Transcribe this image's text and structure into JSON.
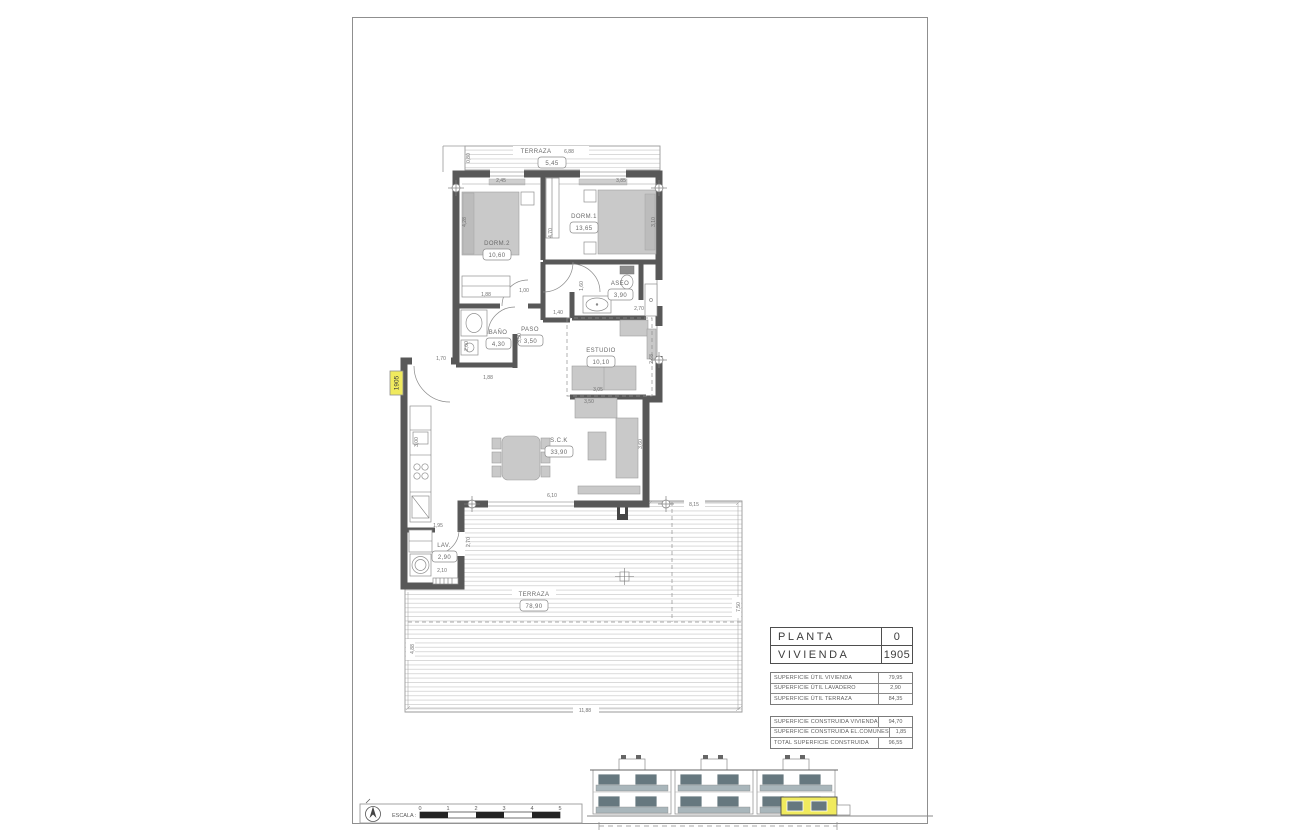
{
  "colors": {
    "wall": "#585858",
    "furniture": "#c9c9c9",
    "deck_line": "#dadada",
    "highlight_yellow": "#f0ea5e",
    "elevation_glass": "#66787f"
  },
  "plan": {
    "unit_tag": "1905",
    "rooms": [
      {
        "label": "TERRAZA",
        "area": "5,45"
      },
      {
        "label": "DORM.2",
        "area": "10,60"
      },
      {
        "label": "DORM.1",
        "area": "13,65"
      },
      {
        "label": "ASEO",
        "area": "3,90"
      },
      {
        "label": "BAÑO",
        "area": "4,30"
      },
      {
        "label": "PASO",
        "area": "3,50"
      },
      {
        "label": "ESTUDIO",
        "area": "10,10"
      },
      {
        "label": "S.C.K",
        "area": "33,90"
      },
      {
        "label": "LAV.",
        "area": "2,90"
      },
      {
        "label": "TERRAZA",
        "area": "78,90"
      }
    ],
    "dims": [
      {
        "t": "6,88"
      },
      {
        "t": "0,80"
      },
      {
        "t": "2,45"
      },
      {
        "t": "3,85"
      },
      {
        "t": "4,28"
      },
      {
        "t": "3,10"
      },
      {
        "t": "4,70"
      },
      {
        "t": "1,00"
      },
      {
        "t": "1,88"
      },
      {
        "t": "1,60"
      },
      {
        "t": "2,70"
      },
      {
        "t": "1,40"
      },
      {
        "t": "2,00"
      },
      {
        "t": "3,50"
      },
      {
        "t": "1,88"
      },
      {
        "t": "2,68"
      },
      {
        "t": "3,05"
      },
      {
        "t": "3,50"
      },
      {
        "t": "1,70"
      },
      {
        "t": "3,00"
      },
      {
        "t": "3,60"
      },
      {
        "t": "6,10"
      },
      {
        "t": "1,95"
      },
      {
        "t": "2,10"
      },
      {
        "t": "2,70"
      },
      {
        "t": "8,15"
      },
      {
        "t": "7,50"
      },
      {
        "t": "11,88"
      },
      {
        "t": "4,88"
      }
    ]
  },
  "title_table": {
    "rows": [
      {
        "label": "PLANTA",
        "value": "0"
      },
      {
        "label": "VIVIENDA",
        "value": "1905"
      }
    ]
  },
  "surface_util": {
    "rows": [
      {
        "label": "SUPERFICIE ÚTIL VIVIENDA",
        "value": "79,95"
      },
      {
        "label": "SUPERFICIE ÚTIL LAVADERO",
        "value": "2,90"
      },
      {
        "label": "SUPERFICIE ÚTIL TERRAZA",
        "value": "84,35"
      }
    ]
  },
  "surface_constructed": {
    "rows": [
      {
        "label": "SUPERFICIE CONSTRUIDA VIVIENDA",
        "value": "94,70"
      },
      {
        "label": "SUPERFICIE CONSTRUIDA EL.COMUNES",
        "value": "1,85"
      },
      {
        "label": "TOTAL SUPERFICIE CONSTRUIDA",
        "value": "96,55"
      }
    ]
  },
  "scale_bar": {
    "label": "ESCALA :",
    "ticks": [
      "0",
      "1",
      "2",
      "3",
      "4",
      "5"
    ]
  }
}
